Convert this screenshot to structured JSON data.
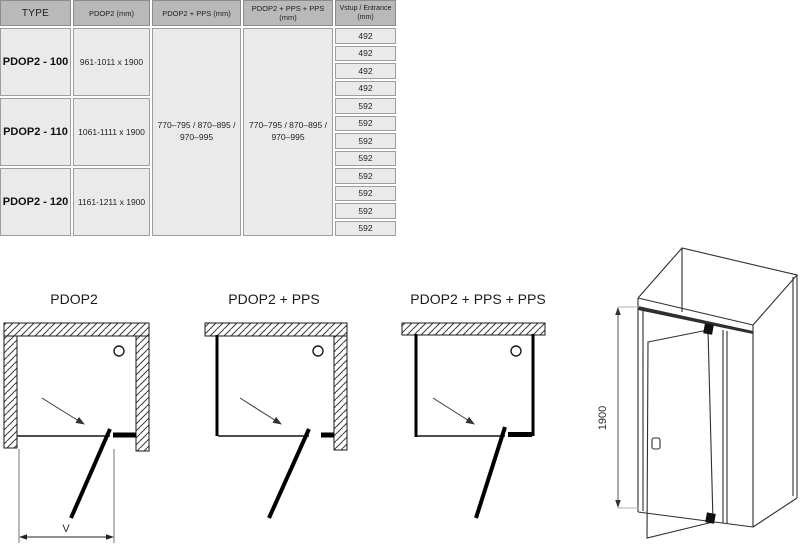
{
  "table": {
    "headers": {
      "type": "TYPE",
      "pdop2": "PDOP2 (mm)",
      "pdop2_pps": "PDOP2 + PPS (mm)",
      "pdop2_pps_pps": "PDOP2 + PPS + PPS (mm)",
      "entrance_line1": "Vstup / Entrance",
      "entrance_line2": "(mm)"
    },
    "rows": [
      {
        "type": "PDOP2 - 100",
        "size": "961-1011 x 1900"
      },
      {
        "type": "PDOP2 - 110",
        "size": "1061-1111 x 1900"
      },
      {
        "type": "PDOP2 - 120",
        "size": "1161-1211 x 1900"
      }
    ],
    "pps_range_line1": "770–795 / 870–895 /",
    "pps_range_line2": "970–995",
    "entrance_values": [
      "492",
      "492",
      "492",
      "492",
      "592",
      "592",
      "592",
      "592",
      "592",
      "592",
      "592",
      "592"
    ]
  },
  "diagrams": {
    "pdop2_title": "PDOP2",
    "pdop2_pps_title": "PDOP2 + PPS",
    "pdop2_pps_pps_title": "PDOP2 + PPS + PPS",
    "width_dim_label": "V",
    "height_dim_label": "1900"
  },
  "colors": {
    "header_bg": "#b9b9b9",
    "cell_bg": "#eaeaea",
    "cell_border": "#9e9e9e",
    "line": "#2f2f2f"
  }
}
